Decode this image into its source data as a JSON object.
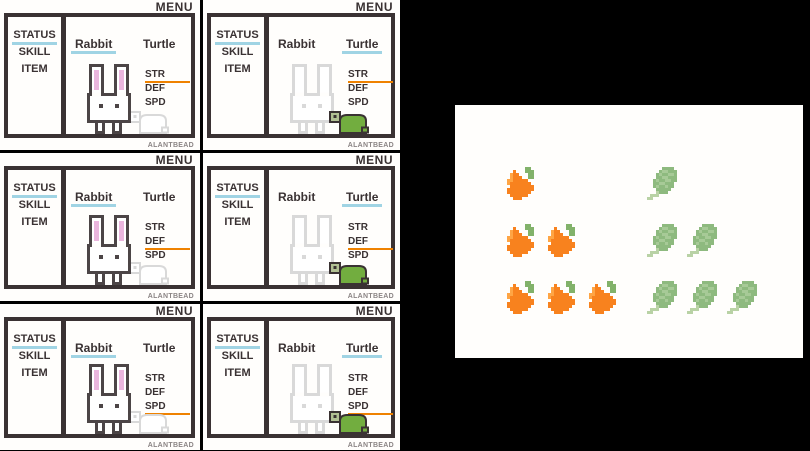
{
  "credit": "ALANTBEAD",
  "colors": {
    "frame_dark": "#3a3233",
    "sprite_outline": "#4c4546",
    "inactive_gray": "#d9d9d9",
    "accent_cyan": "#a0d4e4",
    "accent_orange": "#ef8200",
    "ear_pink": "#eab5dd",
    "turtle_green": "#72ad3f",
    "turtle_head": "#b2c194",
    "paper_white": "#fffefc"
  },
  "screens": [
    {
      "menu_label": "MENU",
      "sidebar": [
        "STATUS",
        "SKILL",
        "ITEM"
      ],
      "sidebar_active": "STATUS",
      "tabs": [
        "Rabbit",
        "Turtle"
      ],
      "active_tab": "Rabbit",
      "stats": [
        "STR",
        "DEF",
        "SPD"
      ],
      "active_stat": "STR",
      "credit": "ALANTBEAD"
    },
    {
      "menu_label": "MENU",
      "sidebar": [
        "STATUS",
        "SKILL",
        "ITEM"
      ],
      "sidebar_active": "STATUS",
      "tabs": [
        "Rabbit",
        "Turtle"
      ],
      "active_tab": "Turtle",
      "stats": [
        "STR",
        "DEF",
        "SPD"
      ],
      "active_stat": "STR",
      "credit": "ALANTBEAD"
    },
    {
      "menu_label": "MENU",
      "sidebar": [
        "STATUS",
        "SKILL",
        "ITEM"
      ],
      "sidebar_active": "STATUS",
      "tabs": [
        "Rabbit",
        "Turtle"
      ],
      "active_tab": "Rabbit",
      "stats": [
        "STR",
        "DEF",
        "SPD"
      ],
      "active_stat": "DEF",
      "credit": "ALANTBEAD"
    },
    {
      "menu_label": "MENU",
      "sidebar": [
        "STATUS",
        "SKILL",
        "ITEM"
      ],
      "sidebar_active": "STATUS",
      "tabs": [
        "Rabbit",
        "Turtle"
      ],
      "active_tab": "Turtle",
      "stats": [
        "STR",
        "DEF",
        "SPD"
      ],
      "active_stat": "DEF",
      "credit": "ALANTBEAD"
    },
    {
      "menu_label": "MENU",
      "sidebar": [
        "STATUS",
        "SKILL",
        "ITEM"
      ],
      "sidebar_active": "STATUS",
      "tabs": [
        "Rabbit",
        "Turtle"
      ],
      "active_tab": "Rabbit",
      "stats": [
        "STR",
        "DEF",
        "SPD"
      ],
      "active_stat": "SPD",
      "credit": "ALANTBEAD"
    },
    {
      "menu_label": "MENU",
      "sidebar": [
        "STATUS",
        "SKILL",
        "ITEM"
      ],
      "sidebar_active": "STATUS",
      "tabs": [
        "Rabbit",
        "Turtle"
      ],
      "active_tab": "Turtle",
      "stats": [
        "STR",
        "DEF",
        "SPD"
      ],
      "active_stat": "SPD",
      "credit": "ALANTBEAD"
    }
  ],
  "food_panel": {
    "groups": [
      {
        "item": "carrot",
        "rows": [
          1,
          2,
          3
        ],
        "palette": {
          "O": "#f8821e",
          "H": "#ffa544",
          "G": "#82b26a"
        }
      },
      {
        "item": "greens",
        "rows": [
          1,
          2,
          3
        ],
        "palette": {
          "B": "#8eba7f",
          "C": "#a7ca97",
          "S": "#b9d2a5"
        }
      }
    ]
  }
}
